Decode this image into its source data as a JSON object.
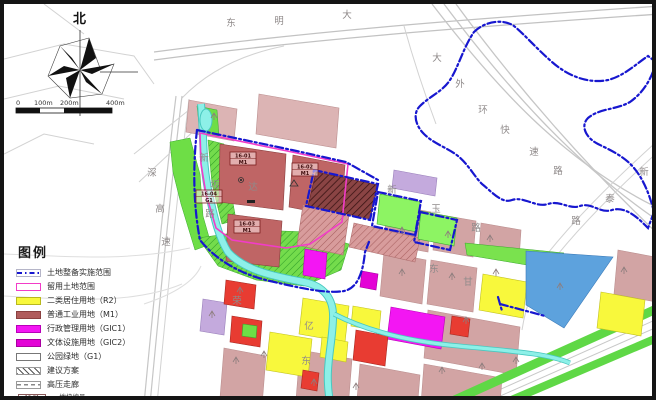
{
  "compass": {
    "north_label": "北"
  },
  "scalebar": {
    "ticks": [
      "0",
      "100m",
      "200m",
      "400m"
    ]
  },
  "legend": {
    "title": "图例",
    "items": [
      {
        "label": "土地整备实施范围",
        "type": "boundary"
      },
      {
        "label": "留用土地范围",
        "type": "retained"
      },
      {
        "label": "二类居住用地（R2）",
        "type": "r2"
      },
      {
        "label": "普通工业用地（M1）",
        "type": "m1"
      },
      {
        "label": "行政管理用地（GIC1）",
        "type": "gic1"
      },
      {
        "label": "文体设施用地（GIC2）",
        "type": "gic2"
      },
      {
        "label": "公园绿地（G1）",
        "type": "g1"
      },
      {
        "label": "建议方案",
        "type": "proposal"
      },
      {
        "label": "高压走廊",
        "type": "corridor"
      }
    ],
    "note": {
      "sample_id": "16-01",
      "sample_code": "M1",
      "numerator": "地块编号",
      "denominator": "用地性质代码"
    }
  },
  "plots": [
    {
      "id": "16-01",
      "code": "M1",
      "x": 226,
      "y": 148
    },
    {
      "id": "16-02",
      "code": "M1",
      "x": 288,
      "y": 159
    },
    {
      "id": "16-03",
      "code": "M1",
      "x": 230,
      "y": 216
    },
    {
      "id": "16-04",
      "code": "G1",
      "x": 192,
      "y": 186
    }
  ],
  "road_labels": [
    {
      "t": "东",
      "x": 227,
      "y": 22
    },
    {
      "t": "明",
      "x": 275,
      "y": 20
    },
    {
      "t": "大",
      "x": 343,
      "y": 14
    },
    {
      "t": "大",
      "x": 433,
      "y": 57
    },
    {
      "t": "外",
      "x": 456,
      "y": 83
    },
    {
      "t": "环",
      "x": 479,
      "y": 109
    },
    {
      "t": "快",
      "x": 501,
      "y": 129
    },
    {
      "t": "速",
      "x": 530,
      "y": 151
    },
    {
      "t": "路",
      "x": 554,
      "y": 170
    },
    {
      "t": "新",
      "x": 640,
      "y": 171
    },
    {
      "t": "泰",
      "x": 606,
      "y": 198
    },
    {
      "t": "路",
      "x": 572,
      "y": 220
    },
    {
      "t": "深",
      "x": 148,
      "y": 172
    },
    {
      "t": "高",
      "x": 156,
      "y": 208
    },
    {
      "t": "速",
      "x": 162,
      "y": 241
    },
    {
      "t": "新",
      "x": 200,
      "y": 157
    },
    {
      "t": "坂",
      "x": 211,
      "y": 184
    },
    {
      "t": "路",
      "x": 206,
      "y": 213
    },
    {
      "t": "达",
      "x": 249,
      "y": 186
    },
    {
      "t": "新",
      "x": 388,
      "y": 189
    },
    {
      "t": "玉",
      "x": 432,
      "y": 208
    },
    {
      "t": "路",
      "x": 472,
      "y": 227
    },
    {
      "t": "东",
      "x": 302,
      "y": 360
    },
    {
      "t": "荣",
      "x": 233,
      "y": 300
    },
    {
      "t": "亿",
      "x": 305,
      "y": 325
    },
    {
      "t": "东",
      "x": 430,
      "y": 268
    },
    {
      "t": "甘",
      "x": 464,
      "y": 281
    }
  ],
  "symbols": [
    [
      398,
      226
    ],
    [
      444,
      230
    ],
    [
      486,
      234
    ],
    [
      620,
      266
    ],
    [
      398,
      268
    ],
    [
      448,
      272
    ],
    [
      492,
      268
    ],
    [
      556,
      282
    ],
    [
      462,
      316
    ],
    [
      438,
      366
    ],
    [
      478,
      362
    ],
    [
      512,
      356
    ],
    [
      310,
      378
    ],
    [
      352,
      382
    ],
    [
      260,
      350
    ],
    [
      232,
      356
    ],
    [
      236,
      286
    ],
    [
      208,
      310
    ],
    [
      210,
      112
    ]
  ],
  "colors": {
    "boundary_blue": "#1717cf",
    "retained_pink": "#f23cc8",
    "residential_r2": "#f8f83c",
    "industrial_m1": "#b05c5c",
    "admin_gic1": "#f316f3",
    "culture_gic2": "#e303d6",
    "park_green": "#6ede46",
    "water_cyan": "#8df0e8",
    "existing_pink": "#d2a4a4",
    "proposal_dark": "#8a4444",
    "water_parcel_blue": "#5da2dd",
    "purple_parcel": "#c4aadd",
    "red_parcel": "#e83c32"
  }
}
